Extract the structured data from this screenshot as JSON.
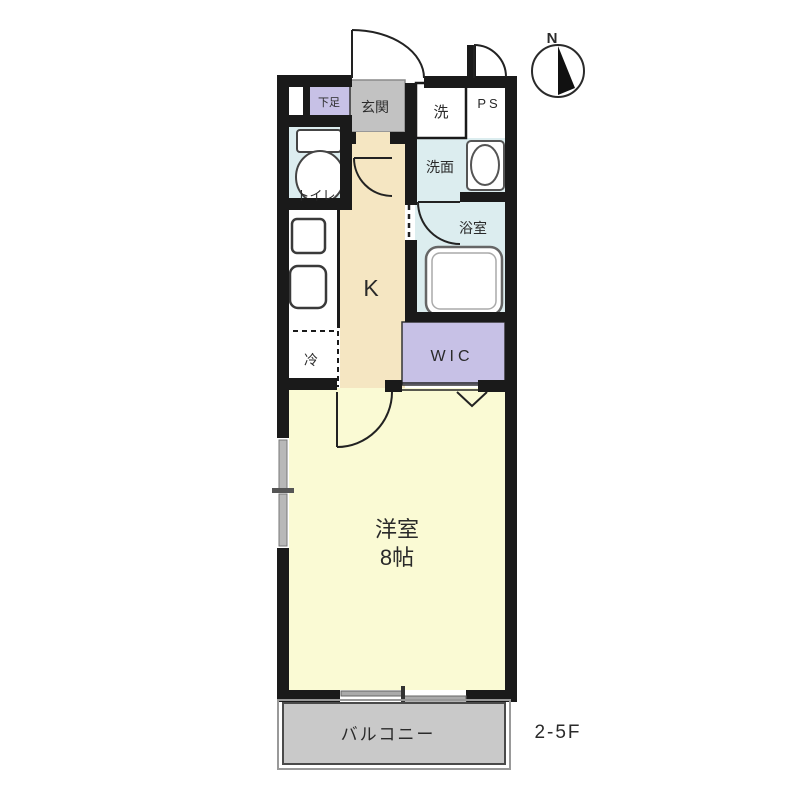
{
  "rooms": {
    "geta": {
      "label": "下足"
    },
    "genkan": {
      "label": "玄関"
    },
    "washer": {
      "label": "洗"
    },
    "ps": {
      "label": "PS"
    },
    "toilet": {
      "label": "トイレ"
    },
    "washroom": {
      "label": "洗面"
    },
    "bathroom": {
      "label": "浴室"
    },
    "kitchen": {
      "label": "K"
    },
    "fridge": {
      "label": "冷"
    },
    "wic": {
      "label": "WIC"
    },
    "main_room": {
      "label": "洋室",
      "size": "8帖"
    },
    "balcony": {
      "label": "バルコニー"
    }
  },
  "annotations": {
    "floor_range": "2-5F",
    "compass_north": "N"
  },
  "colors": {
    "wall": "#1a1a1a",
    "wet_area": "#dcedef",
    "kitchen": "#f5e6c2",
    "main_room": "#fafad4",
    "closet": "#c7c1e6",
    "entrance": "#c2c2c2",
    "balcony": "#c9c9c9",
    "text": "#2a2a2a"
  }
}
